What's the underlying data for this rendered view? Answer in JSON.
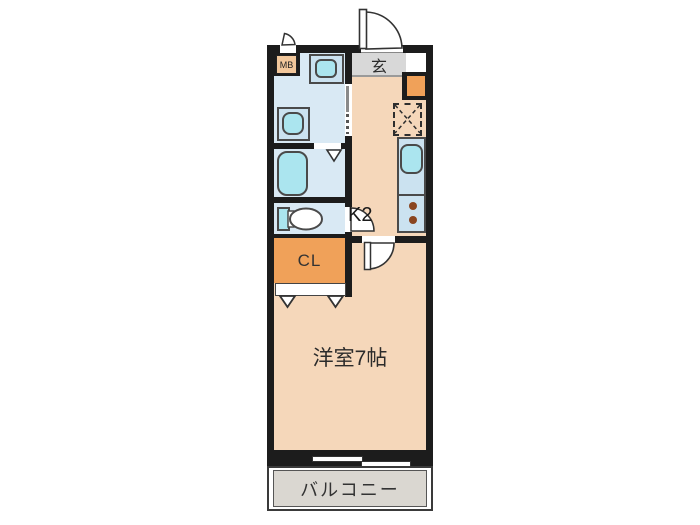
{
  "title": "apartment-floor-plan",
  "colors": {
    "wall": "#1c1c1c",
    "tan": "#f5d7ba",
    "orange": "#f0a159",
    "mbOrange": "#f2c79b",
    "blueRoom": "#d9e9f4",
    "blueFix": "#cbe2f0",
    "cyan": "#abe5ef",
    "genkan": "#d8d8d8",
    "balcony": "#dad7d1",
    "burner": "#8a4520",
    "ink": "#2b2b2b"
  },
  "rooms": {
    "meter_box": {
      "label": "MB"
    },
    "entrance": {
      "label": "玄"
    },
    "kitchen": {
      "label": "K2"
    },
    "closet": {
      "label": "CL"
    },
    "western_room": {
      "label": "洋室7帖"
    },
    "balcony": {
      "label": "バルコニー"
    }
  }
}
